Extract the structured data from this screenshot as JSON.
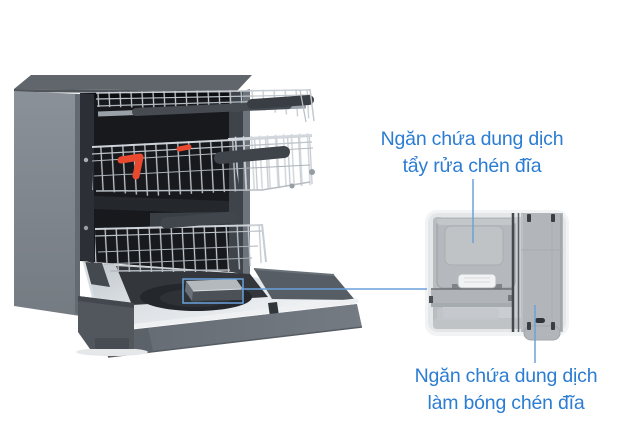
{
  "figure": {
    "background": "#ffffff"
  },
  "callouts": {
    "detergent": {
      "line1": "Ngăn chứa dung dịch",
      "line2": "tẩy rửa chén đĩa"
    },
    "rinse_aid": {
      "line1": "Ngăn chứa dung dịch",
      "line2": "làm bóng chén đĩa"
    }
  },
  "colors": {
    "label_text": "#2b7cd3",
    "callout_line": "#6aa2db",
    "highlight_box": "#6aa2db",
    "accent_red": "#e8492f"
  }
}
